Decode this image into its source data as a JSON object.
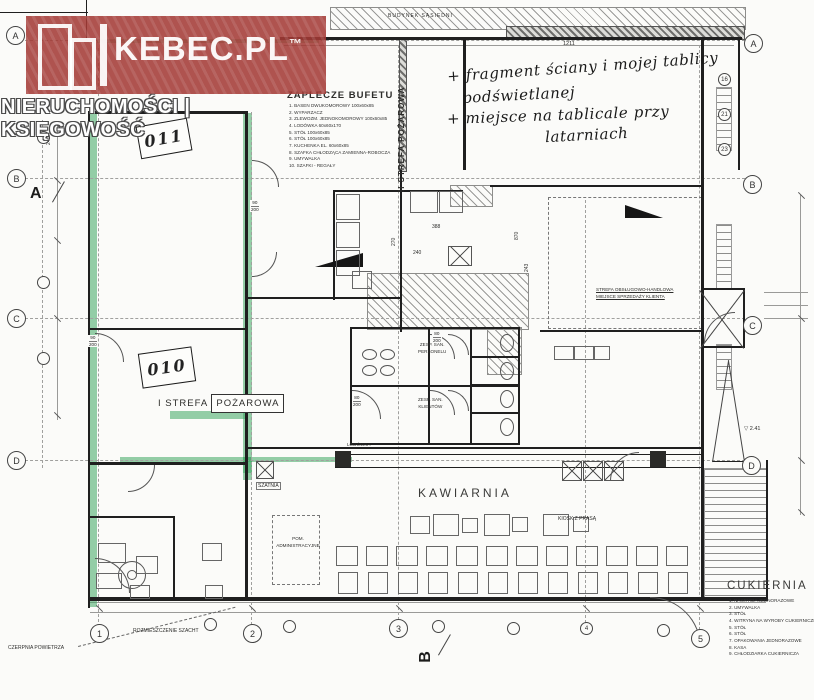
{
  "watermark": {
    "brand": "KEBEC.PL",
    "tm": "™",
    "tagline": "NIERUCHOMOŚCI | KSIĘGOWOŚĆ",
    "brand_color": "#a33935"
  },
  "notes": {
    "l1": "+ fragment ściany i mojej tablicy",
    "l2": "podświetlanej",
    "l3": "+ miejsce na tablicale przy",
    "l4": "latarniach"
  },
  "areas": {
    "zaplecze": {
      "title": "ZAPLECZE BUFETU",
      "items": [
        "1. BASEN DWUKOMOROWY 100x60x85",
        "2. WYPARZACZ",
        "3. ZLEWOZM. JEDNOKOMOROWY 100x60x85",
        "4. LODÓWKA 60x60x170",
        "5. STÓŁ 100x60x85",
        "6. STÓŁ 100x60x85",
        "7. KUCHENKA EL. 60x60x85",
        "8. SZAFKA CHŁODZĄCA ZAMIENNA-ROBOCZA",
        "9. UMYWALKA",
        "10. SZAFKI - REGAŁY"
      ]
    },
    "cukiernia": {
      "title": "CUKIERNIA",
      "items": [
        "1. NAKRYCIA JEDNORAZOWE",
        "2. UMYWALKA",
        "3. STÓŁ",
        "4. WITRYNA NA WYROBY CUKIERNICZE",
        "5. STÓŁ",
        "6. STÓŁ",
        "7. OPAKOWANIA JEDNORAZOWE",
        "8. KASA",
        "9. CHŁODZIARKA CUKIERNICZA"
      ]
    },
    "fire2": "II STREFA POŻAROWA",
    "fire1a": "I STREFA",
    "fire1b": "POŻAROWA",
    "kawiarnia": "KAWIARNIA",
    "szatnia": "SZATNIA",
    "san_pers_1": "ZESP. SAN.",
    "san_pers_2": "PERSONELU",
    "san_kli_1": "ZESP. SAN.",
    "san_kli_2": "KLIENTÓW",
    "pom1": "POM.",
    "pom2": "ADMINISTRACYJNE",
    "kiosk": "KIOSK Z PRASĄ",
    "lodowka": "LODÓWKA",
    "neighbor": "BUDYNEK SĄSIEDNI",
    "czerpnia": "CZERPNIA POWIETRZA",
    "szachty": "ROZMIESZCZENIE SZACHT",
    "note_r1": "STREFA OBSŁUGOWO-HANDLOWA",
    "note_r2": "MIEJSCE SPRZEDAŻY KLIENTA",
    "room011": "011",
    "room010": "010"
  },
  "dims": {
    "top": "1211",
    "d388": "388",
    "d240": "240",
    "d270": "270",
    "d870": "870",
    "d243": "243",
    "level": "▽ 2.41",
    "left240": "240"
  },
  "doors": [
    [
      "90",
      "200"
    ],
    [
      "80",
      "200"
    ],
    [
      "80",
      "200"
    ],
    [
      "90",
      "200"
    ]
  ],
  "grid": {
    "left": [
      "A",
      "B",
      "C",
      "D"
    ],
    "right": [
      "A",
      "B",
      "C",
      "D"
    ],
    "right_small": [
      "16",
      "21",
      "23"
    ],
    "bottom": [
      "1",
      "2",
      "3",
      "5"
    ],
    "bottom_small": "4",
    "section_a": "A",
    "section_b": "B"
  }
}
